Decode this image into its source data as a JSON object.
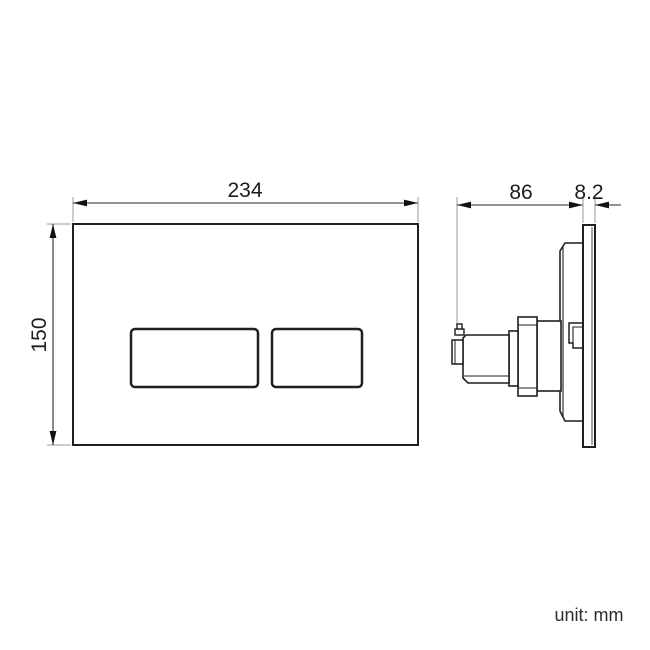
{
  "drawing": {
    "unit_label": "unit: mm",
    "front_view": {
      "width_label": "234",
      "height_label": "150"
    },
    "side_view": {
      "depth_label": "86",
      "thickness_label": "8.2"
    },
    "colors": {
      "line": "#1f1f1f",
      "dimension_line": "#2a2a2a",
      "extension_line": "#9b9b9b",
      "background": "#ffffff",
      "text": "#1c1c1c"
    }
  }
}
